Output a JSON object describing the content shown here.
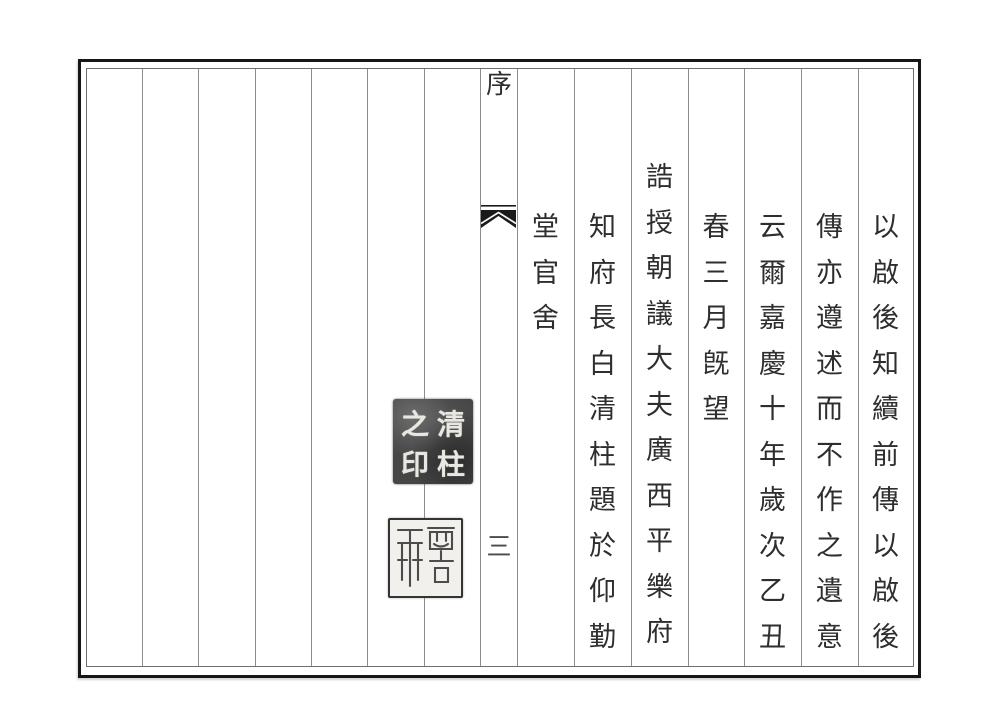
{
  "document": {
    "type": "Scanned page of a classical Chinese book preface; vertical text read right-to-left inside a double-ruled frame with column rules",
    "background": "#ffffff",
    "frame_color": "#161616",
    "column_rule_color": "#8d8d8d",
    "ink_color": "#2e2e2e"
  },
  "banxin": {
    "section_title": "序",
    "page_number": "三",
    "fishtail_icon": "black fishtail (yuwei) center-fold printer's mark"
  },
  "text_columns": [
    {
      "text": "以啟後知續前傳以啟後",
      "elevated": false
    },
    {
      "text": "傳亦遵述而不作之遺意",
      "elevated": false
    },
    {
      "text": "云爾嘉慶十年歲次乙丑",
      "elevated": false
    },
    {
      "text": "春三月旣望",
      "elevated": false
    },
    {
      "text": "誥授朝議大夫廣西平樂府",
      "elevated": true
    },
    {
      "text": "知府長白清柱題於仰勤",
      "elevated": false
    },
    {
      "text": "堂官舍",
      "elevated": false
    }
  ],
  "seals": [
    {
      "text": "清柱之印",
      "style": "intaglio name seal — white seal-script characters on dark mottled impression",
      "grid": {
        "top_left": "之",
        "top_right": "清",
        "bottom_left": "印",
        "bottom_right": "柱"
      }
    },
    {
      "text": "",
      "style": "relief seal — two columns of undeciphered seal script, dark strokes on light ground with dark border"
    }
  ]
}
